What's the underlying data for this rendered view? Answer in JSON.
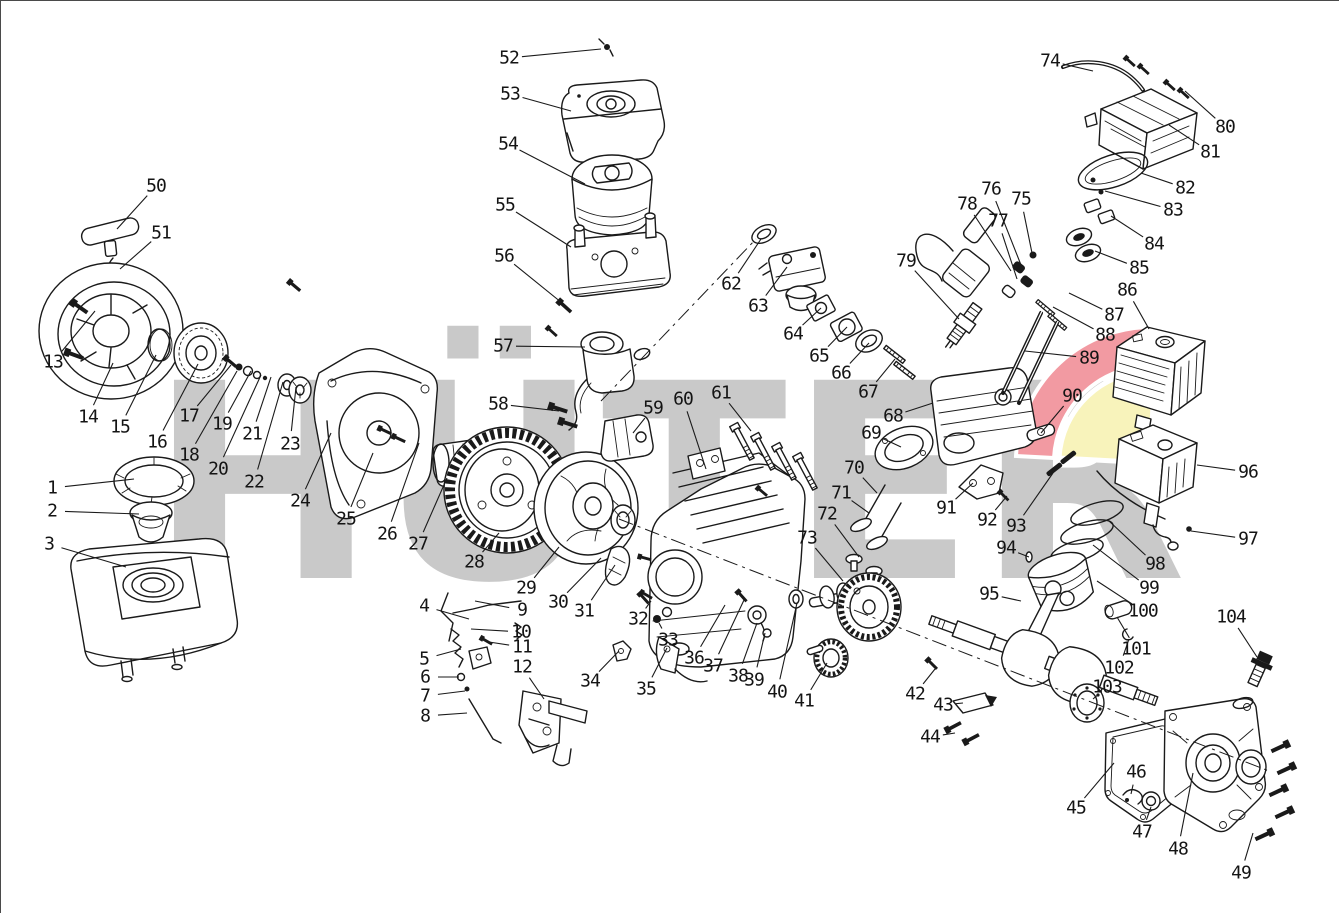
{
  "watermark": {
    "text": "HÜTER",
    "color": "#c9c9c9",
    "accent_red": "#f29aa2",
    "accent_yellow": "#f8f3bb"
  },
  "diagram": {
    "type": "exploded-parts-diagram",
    "subject": "small gasoline engine exploded view",
    "line_color": "#1a1a1a",
    "axes": [
      {
        "x1": 618,
        "y1": 518,
        "x2": 1268,
        "y2": 770
      },
      {
        "x1": 600,
        "y1": 400,
        "x2": 755,
        "y2": 238
      }
    ],
    "callouts": [
      {
        "n": "1",
        "x": 51,
        "y": 487,
        "tx": 133,
        "ty": 478
      },
      {
        "n": "2",
        "x": 51,
        "y": 510,
        "tx": 138,
        "ty": 513
      },
      {
        "n": "3",
        "x": 48,
        "y": 543,
        "tx": 125,
        "ty": 566
      },
      {
        "n": "4",
        "x": 423,
        "y": 605,
        "tx": 468,
        "ty": 618
      },
      {
        "n": "5",
        "x": 423,
        "y": 658,
        "tx": 460,
        "ty": 648
      },
      {
        "n": "6",
        "x": 424,
        "y": 676,
        "tx": 458,
        "ty": 676
      },
      {
        "n": "7",
        "x": 424,
        "y": 695,
        "tx": 464,
        "ty": 690
      },
      {
        "n": "8",
        "x": 424,
        "y": 715,
        "tx": 466,
        "ty": 712
      },
      {
        "n": "9",
        "x": 521,
        "y": 609,
        "tx": 474,
        "ty": 600
      },
      {
        "n": "10",
        "x": 520,
        "y": 631,
        "tx": 470,
        "ty": 628
      },
      {
        "n": "11",
        "x": 521,
        "y": 646,
        "tx": 488,
        "ty": 641
      },
      {
        "n": "12",
        "x": 521,
        "y": 666,
        "tx": 543,
        "ty": 698
      },
      {
        "n": "13",
        "x": 52,
        "y": 361,
        "tx": 94,
        "ty": 310
      },
      {
        "n": "14",
        "x": 87,
        "y": 416,
        "tx": 112,
        "ty": 362
      },
      {
        "n": "15",
        "x": 119,
        "y": 426,
        "tx": 155,
        "ty": 354
      },
      {
        "n": "16",
        "x": 156,
        "y": 441,
        "tx": 197,
        "ty": 363
      },
      {
        "n": "17",
        "x": 188,
        "y": 415,
        "tx": 230,
        "ty": 364
      },
      {
        "n": "18",
        "x": 188,
        "y": 454,
        "tx": 236,
        "ty": 370
      },
      {
        "n": "19",
        "x": 221,
        "y": 423,
        "tx": 250,
        "ty": 370
      },
      {
        "n": "20",
        "x": 217,
        "y": 468,
        "tx": 260,
        "ty": 374
      },
      {
        "n": "21",
        "x": 251,
        "y": 433,
        "tx": 270,
        "ty": 376
      },
      {
        "n": "22",
        "x": 253,
        "y": 481,
        "tx": 282,
        "ty": 381
      },
      {
        "n": "23",
        "x": 289,
        "y": 443,
        "tx": 295,
        "ty": 386
      },
      {
        "n": "24",
        "x": 299,
        "y": 500,
        "tx": 330,
        "ty": 432
      },
      {
        "n": "25",
        "x": 345,
        "y": 518,
        "tx": 372,
        "ty": 452
      },
      {
        "n": "26",
        "x": 386,
        "y": 533,
        "tx": 418,
        "ty": 442
      },
      {
        "n": "27",
        "x": 417,
        "y": 543,
        "tx": 446,
        "ty": 477
      },
      {
        "n": "28",
        "x": 473,
        "y": 561,
        "tx": 498,
        "ty": 532
      },
      {
        "n": "29",
        "x": 525,
        "y": 587,
        "tx": 558,
        "ty": 546
      },
      {
        "n": "30",
        "x": 557,
        "y": 601,
        "tx": 600,
        "ty": 557
      },
      {
        "n": "31",
        "x": 583,
        "y": 610,
        "tx": 614,
        "ty": 564
      },
      {
        "n": "32",
        "x": 637,
        "y": 618,
        "tx": 650,
        "ty": 600
      },
      {
        "n": "33",
        "x": 667,
        "y": 639,
        "tx": 658,
        "ty": 622
      },
      {
        "n": "34",
        "x": 589,
        "y": 680,
        "tx": 618,
        "ty": 650
      },
      {
        "n": "35",
        "x": 645,
        "y": 688,
        "tx": 666,
        "ty": 647
      },
      {
        "n": "36",
        "x": 693,
        "y": 657,
        "tx": 724,
        "ty": 604
      },
      {
        "n": "37",
        "x": 712,
        "y": 665,
        "tx": 743,
        "ty": 599
      },
      {
        "n": "38",
        "x": 737,
        "y": 675,
        "tx": 756,
        "ty": 622
      },
      {
        "n": "39",
        "x": 753,
        "y": 679,
        "tx": 764,
        "ty": 632
      },
      {
        "n": "40",
        "x": 776,
        "y": 691,
        "tx": 796,
        "ty": 602
      },
      {
        "n": "41",
        "x": 803,
        "y": 700,
        "tx": 826,
        "ty": 662
      },
      {
        "n": "42",
        "x": 914,
        "y": 693,
        "tx": 934,
        "ty": 668
      },
      {
        "n": "43",
        "x": 942,
        "y": 704,
        "tx": 962,
        "ty": 702
      },
      {
        "n": "44",
        "x": 929,
        "y": 736,
        "tx": 954,
        "ty": 732
      },
      {
        "n": "45",
        "x": 1075,
        "y": 807,
        "tx": 1113,
        "ty": 762
      },
      {
        "n": "46",
        "x": 1135,
        "y": 771,
        "tx": 1130,
        "ty": 793
      },
      {
        "n": "47",
        "x": 1141,
        "y": 831,
        "tx": 1150,
        "ty": 806
      },
      {
        "n": "48",
        "x": 1177,
        "y": 848,
        "tx": 1192,
        "ty": 772
      },
      {
        "n": "49",
        "x": 1240,
        "y": 872,
        "tx": 1252,
        "ty": 832
      },
      {
        "n": "50",
        "x": 155,
        "y": 185,
        "tx": 116,
        "ty": 228
      },
      {
        "n": "51",
        "x": 160,
        "y": 232,
        "tx": 119,
        "ty": 268
      },
      {
        "n": "52",
        "x": 508,
        "y": 57,
        "tx": 600,
        "ty": 48
      },
      {
        "n": "53",
        "x": 509,
        "y": 93,
        "tx": 570,
        "ty": 110
      },
      {
        "n": "54",
        "x": 507,
        "y": 143,
        "tx": 584,
        "ty": 183
      },
      {
        "n": "55",
        "x": 504,
        "y": 204,
        "tx": 570,
        "ty": 246
      },
      {
        "n": "56",
        "x": 503,
        "y": 255,
        "tx": 566,
        "ty": 306
      },
      {
        "n": "57",
        "x": 502,
        "y": 345,
        "tx": 584,
        "ty": 346
      },
      {
        "n": "58",
        "x": 497,
        "y": 403,
        "tx": 558,
        "ty": 410
      },
      {
        "n": "59",
        "x": 652,
        "y": 407,
        "tx": 632,
        "ty": 432
      },
      {
        "n": "60",
        "x": 682,
        "y": 398,
        "tx": 705,
        "ty": 468
      },
      {
        "n": "61",
        "x": 720,
        "y": 392,
        "tx": 750,
        "ty": 430
      },
      {
        "n": "62",
        "x": 730,
        "y": 283,
        "tx": 760,
        "ty": 238
      },
      {
        "n": "63",
        "x": 757,
        "y": 305,
        "tx": 786,
        "ty": 266
      },
      {
        "n": "64",
        "x": 792,
        "y": 333,
        "tx": 820,
        "ty": 307
      },
      {
        "n": "65",
        "x": 818,
        "y": 355,
        "tx": 846,
        "ty": 326
      },
      {
        "n": "66",
        "x": 840,
        "y": 372,
        "tx": 868,
        "ty": 342
      },
      {
        "n": "67",
        "x": 867,
        "y": 391,
        "tx": 894,
        "ty": 358
      },
      {
        "n": "68",
        "x": 892,
        "y": 415,
        "tx": 932,
        "ty": 402
      },
      {
        "n": "69",
        "x": 870,
        "y": 432,
        "tx": 900,
        "ty": 446
      },
      {
        "n": "70",
        "x": 853,
        "y": 467,
        "tx": 876,
        "ty": 492
      },
      {
        "n": "71",
        "x": 840,
        "y": 492,
        "tx": 868,
        "ty": 512
      },
      {
        "n": "72",
        "x": 826,
        "y": 513,
        "tx": 858,
        "ty": 556
      },
      {
        "n": "73",
        "x": 806,
        "y": 537,
        "tx": 842,
        "ty": 580
      },
      {
        "n": "74",
        "x": 1049,
        "y": 60,
        "tx": 1092,
        "ty": 70
      },
      {
        "n": "75",
        "x": 1020,
        "y": 198,
        "tx": 1031,
        "ty": 252
      },
      {
        "n": "76",
        "x": 990,
        "y": 188,
        "tx": 1020,
        "ty": 264
      },
      {
        "n": "77",
        "x": 997,
        "y": 220,
        "tx": 1016,
        "ty": 278
      },
      {
        "n": "78",
        "x": 966,
        "y": 203,
        "tx": 1010,
        "ty": 270
      },
      {
        "n": "79",
        "x": 905,
        "y": 260,
        "tx": 958,
        "ty": 318
      },
      {
        "n": "80",
        "x": 1224,
        "y": 126,
        "tx": 1184,
        "ty": 90
      },
      {
        "n": "81",
        "x": 1209,
        "y": 151,
        "tx": 1168,
        "ty": 124
      },
      {
        "n": "82",
        "x": 1184,
        "y": 187,
        "tx": 1140,
        "ty": 172
      },
      {
        "n": "83",
        "x": 1172,
        "y": 209,
        "tx": 1104,
        "ty": 190
      },
      {
        "n": "84",
        "x": 1153,
        "y": 243,
        "tx": 1110,
        "ty": 215
      },
      {
        "n": "85",
        "x": 1138,
        "y": 267,
        "tx": 1094,
        "ty": 250
      },
      {
        "n": "86",
        "x": 1126,
        "y": 289,
        "tx": 1148,
        "ty": 328
      },
      {
        "n": "87",
        "x": 1113,
        "y": 314,
        "tx": 1068,
        "ty": 292
      },
      {
        "n": "88",
        "x": 1104,
        "y": 334,
        "tx": 1052,
        "ty": 306
      },
      {
        "n": "89",
        "x": 1088,
        "y": 357,
        "tx": 1024,
        "ty": 350
      },
      {
        "n": "90",
        "x": 1071,
        "y": 395,
        "tx": 1040,
        "ty": 432
      },
      {
        "n": "91",
        "x": 945,
        "y": 507,
        "tx": 972,
        "ty": 482
      },
      {
        "n": "92",
        "x": 986,
        "y": 519,
        "tx": 1006,
        "ty": 495
      },
      {
        "n": "93",
        "x": 1015,
        "y": 525,
        "tx": 1052,
        "ty": 472
      },
      {
        "n": "94",
        "x": 1005,
        "y": 547,
        "tx": 1028,
        "ty": 556
      },
      {
        "n": "95",
        "x": 988,
        "y": 593,
        "tx": 1020,
        "ty": 600
      },
      {
        "n": "96",
        "x": 1247,
        "y": 471,
        "tx": 1196,
        "ty": 464
      },
      {
        "n": "97",
        "x": 1247,
        "y": 538,
        "tx": 1190,
        "ty": 530
      },
      {
        "n": "98",
        "x": 1154,
        "y": 563,
        "tx": 1108,
        "ty": 520
      },
      {
        "n": "99",
        "x": 1148,
        "y": 587,
        "tx": 1092,
        "ty": 544
      },
      {
        "n": "100",
        "x": 1142,
        "y": 610,
        "tx": 1096,
        "ty": 580
      },
      {
        "n": "101",
        "x": 1135,
        "y": 648,
        "tx": 1116,
        "ty": 616
      },
      {
        "n": "102",
        "x": 1118,
        "y": 667,
        "tx": 1128,
        "ty": 638
      },
      {
        "n": "103",
        "x": 1106,
        "y": 686,
        "tx": 1092,
        "ty": 698
      },
      {
        "n": "104",
        "x": 1230,
        "y": 616,
        "tx": 1256,
        "ty": 656
      }
    ]
  }
}
